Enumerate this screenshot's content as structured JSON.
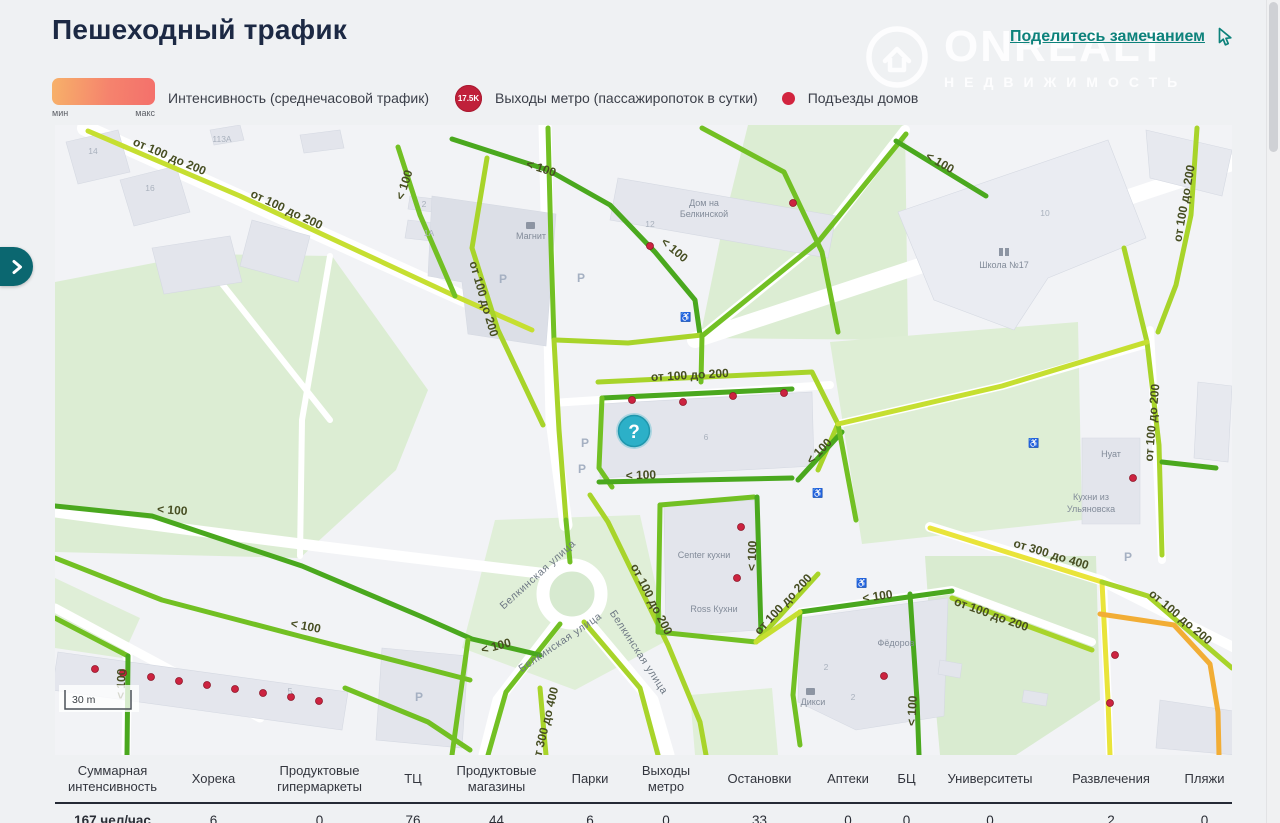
{
  "header": {
    "title": "Пешеходный трафик",
    "share_link": "Поделитесь замечанием"
  },
  "watermark": {
    "brand": "ONREALT",
    "sub": "НЕДВИЖИМОСТЬ"
  },
  "legend": {
    "min": "мин",
    "max": "макс",
    "intensity_label": "Интенсивность (среднечасовой трафик)",
    "metro_badge": "17.5K",
    "metro_label": "Выходы метро (пассажиропоток в сутки)",
    "entrances_label": "Подъезды домов"
  },
  "colors": {
    "accent_teal": "#0d827b",
    "metro_red": "#c0203a",
    "entrance_red": "#d2243e",
    "intensity_min": "#f7b169",
    "intensity_max": "#f4706b"
  },
  "map": {
    "help_marker": "?",
    "scale_label": "30 m",
    "parking_label": "P",
    "traffic_labels": [
      "от 100 до 200",
      "от 100 до 200",
      "< 100",
      "< 100",
      "от 100 до 200",
      "< 100",
      "< 100",
      "от 100 до 200",
      "< 100",
      "< 100",
      "< 100",
      "< 100",
      "< 100",
      "< 100",
      "от 100 до 200",
      "от 100 до 200",
      "< 100",
      "от 100 до 200",
      "от 300 до 400",
      "от 100 до 200",
      "от 100 до 200",
      "от 100 до 200",
      "< 100",
      "< 100",
      "от 300 до 400"
    ],
    "street_labels": [
      "Белкинская улица",
      "Белкинская улица",
      "Белкинская улица"
    ],
    "place_labels": [
      "Магнит",
      "Дом на",
      "Белкинской",
      "Школа №17",
      "Нуат",
      "Кухни из",
      "Ульяновска",
      "Center кухни",
      "Ross Кухни",
      "Фёдоров",
      "Дикси"
    ],
    "house_numbers": [
      "14",
      "16",
      "113А",
      "2",
      "1А",
      "12",
      "10",
      "6",
      "5",
      "2",
      "2"
    ]
  },
  "table": {
    "columns": [
      {
        "header": "Суммарная интенсивность",
        "value": "167 чел/час"
      },
      {
        "header": "Хорека",
        "value": "6"
      },
      {
        "header": "Продуктовые гипермаркеты",
        "value": "0"
      },
      {
        "header": "ТЦ",
        "value": "76"
      },
      {
        "header": "Продуктовые магазины",
        "value": "44"
      },
      {
        "header": "Парки",
        "value": "6"
      },
      {
        "header": "Выходы метро",
        "value": "0"
      },
      {
        "header": "Остановки",
        "value": "33"
      },
      {
        "header": "Аптеки",
        "value": "0"
      },
      {
        "header": "БЦ",
        "value": "0"
      },
      {
        "header": "Университеты",
        "value": "0"
      },
      {
        "header": "Развлечения",
        "value": "2"
      },
      {
        "header": "Пляжи",
        "value": "0"
      }
    ]
  }
}
